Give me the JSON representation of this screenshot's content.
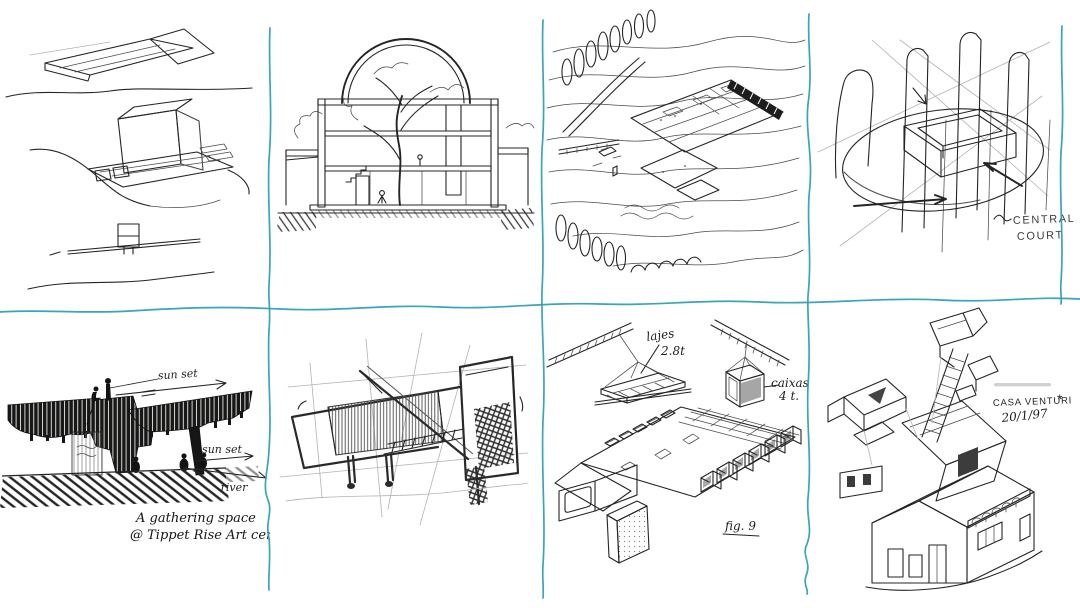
{
  "page": {
    "colors": {
      "paper": "#ffffff",
      "divider_blue": "#2f9fb5",
      "ink": "#242424"
    },
    "grid": {
      "rows": 2,
      "cols": 4
    }
  },
  "panels": [
    {
      "name": "hillside-volumes",
      "description": "Three stacked ink sketches of hatched rectangular building volumes on a hillside"
    },
    {
      "name": "arched-section",
      "description": "Cross-section of a building with arched glass roof, interior tree and stairs"
    },
    {
      "name": "terraced-site",
      "description": "Aerial sketch of a terraced building complex with contour lines and cypress trees"
    },
    {
      "name": "central-court",
      "description": "Loose axonometric of towers around a courtyard with ellipse and arrows",
      "labels": {
        "line1": "CENTRAL",
        "line2": "COURT"
      }
    },
    {
      "name": "tippet-rise-canopy",
      "description": "Dark ink sketch of a sculptural canopy gathering space at Tippet Rise Art Center",
      "labels": {
        "sun_set_top": "sun set",
        "sun_set_right": "sun set",
        "river": "river",
        "caption1": "A  gathering  space",
        "caption2": "@ Tippet Rise Art center"
      }
    },
    {
      "name": "cantilever-study",
      "description": "Soft pencil sketch of an angular cantilevered building on thin supports"
    },
    {
      "name": "precast-isometric",
      "description": "Isometric construction drawing of a precast deck with two cranes lifting slabs and boxes",
      "labels": {
        "lajes": "lajes",
        "lajes_weight": "2.8t",
        "caixas": "caixas",
        "caixas_weight": "4 t.",
        "figure": "fig. 9"
      }
    },
    {
      "name": "casa-venturi",
      "description": "Exploded axonometric sketch of Casa Venturi with stair and roof pieces",
      "labels": {
        "title": "CASA VENTURI",
        "star": "*",
        "date": "20/1/97"
      }
    }
  ]
}
